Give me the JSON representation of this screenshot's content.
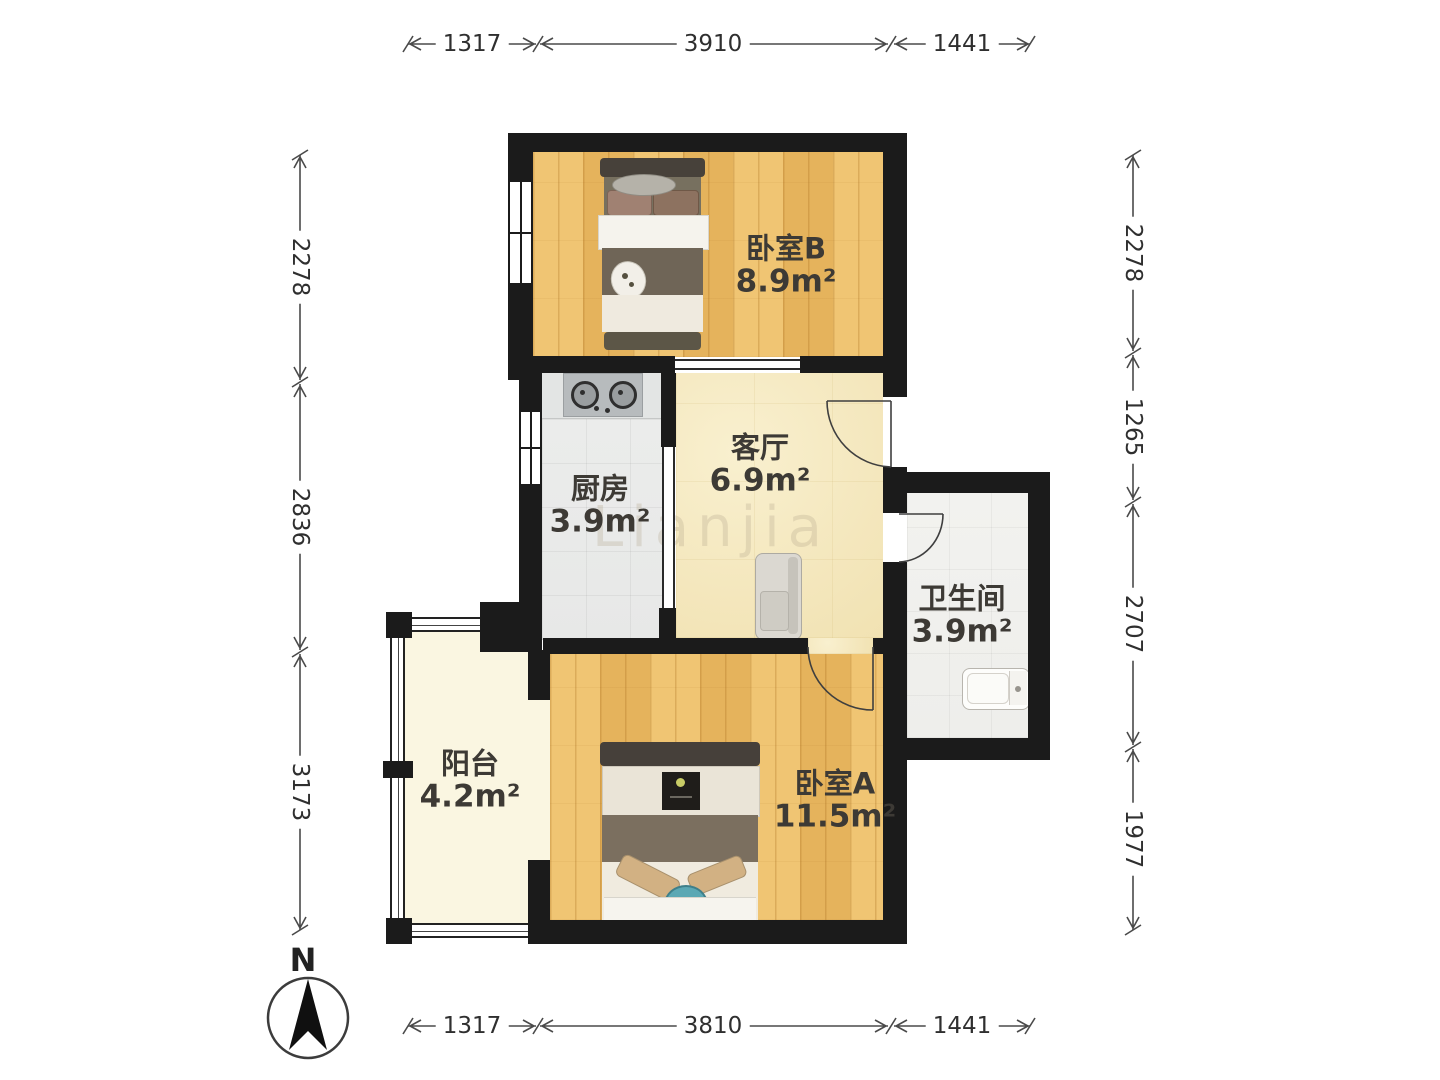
{
  "floorplan": {
    "rooms": [
      {
        "name": "卧室B",
        "area": "8.9m²"
      },
      {
        "name": "客厅",
        "area": "6.9m²"
      },
      {
        "name": "厨房",
        "area": "3.9m²"
      },
      {
        "name": "卫生间",
        "area": "3.9m²"
      },
      {
        "name": "阳台",
        "area": "4.2m²"
      },
      {
        "name": "卧室A",
        "area": "11.5m²"
      }
    ],
    "dimensions_mm": {
      "top": [
        "1317",
        "3910",
        "1441"
      ],
      "bottom": [
        "1317",
        "3810",
        "1441"
      ],
      "left": [
        "2278",
        "2836",
        "3173"
      ],
      "right": [
        "2278",
        "1265",
        "2707",
        "1977"
      ]
    },
    "compass": {
      "label": "N"
    },
    "watermark": "Lianjia",
    "colors": {
      "wall": "#1b1b1b",
      "wood_floor": "#eabf66",
      "living_floor": "#f4e7bd",
      "kitchen_floor": "#ecedec",
      "bath_floor": "#f0f0ed",
      "balcony_floor": "#faf6e1",
      "dimension_text": "#2f2f2f"
    }
  }
}
